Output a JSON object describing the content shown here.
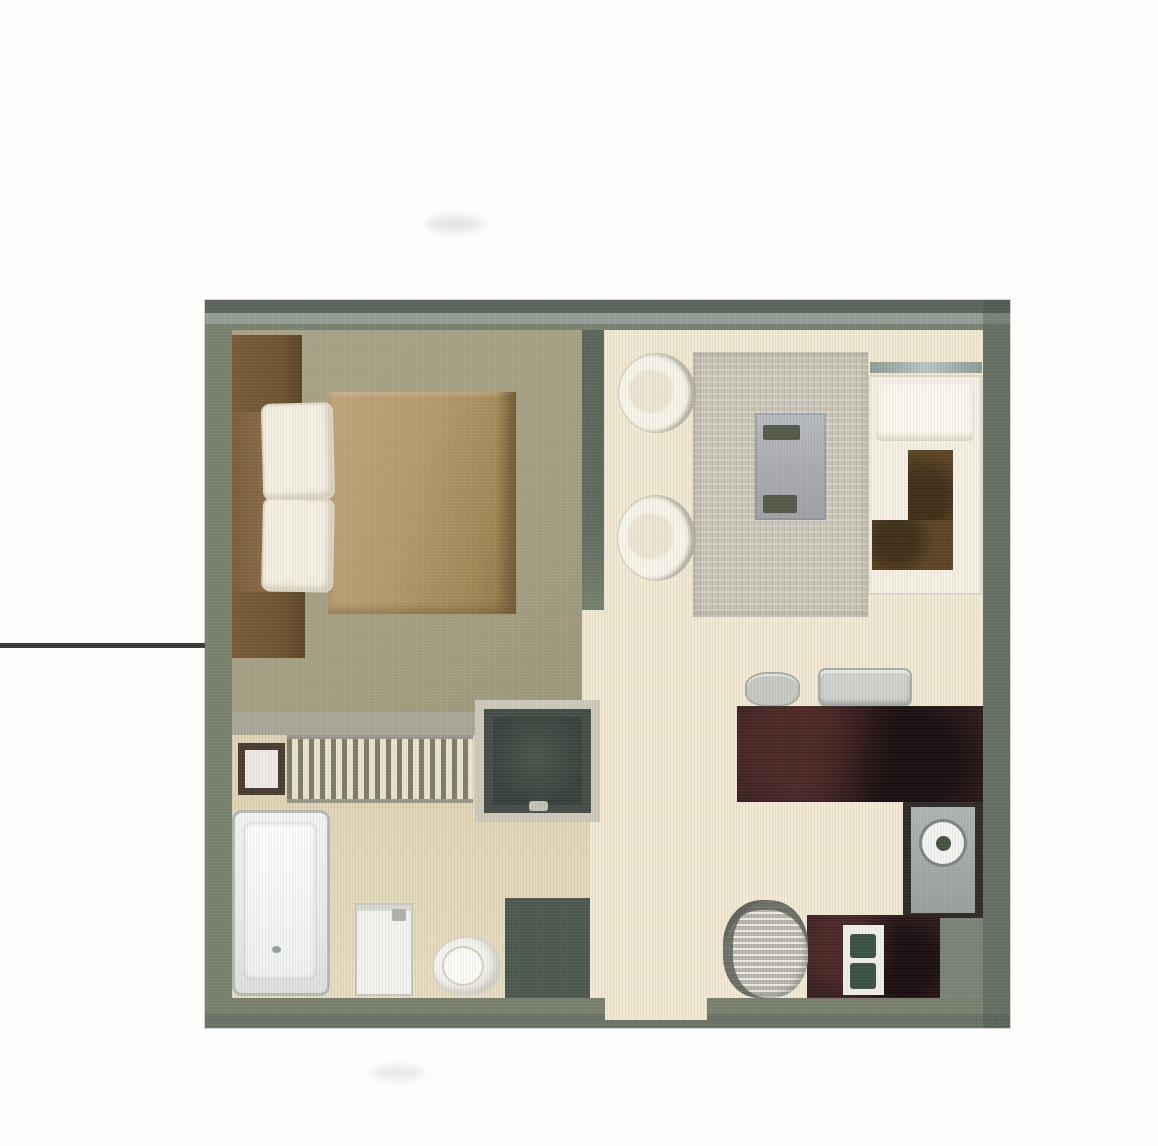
{
  "page": {
    "background_color": "#fdfdfc",
    "description": "Scanned top-down floor plan of a small studio apartment with a callout leader line entering from the left edge",
    "visible_text": []
  },
  "callout": {
    "type": "leader-line",
    "color": "#3c3c3c",
    "side": "left"
  },
  "floor_plan": {
    "type": "studio-apartment",
    "rooms": [
      {
        "name": "bedroom",
        "position": "top-left",
        "floor_color": "#a6a183",
        "furniture": [
          "wardrobe-top",
          "headboard",
          "pillow-1",
          "pillow-2",
          "double-bed-duvet",
          "wardrobe-bottom"
        ]
      },
      {
        "name": "bathroom",
        "position": "bottom-left",
        "floor_color": "#e3d8ba",
        "furniture": [
          "wall-fixture",
          "towel-radiator",
          "shower",
          "bathtub",
          "sink",
          "toilet"
        ]
      },
      {
        "name": "living-dining",
        "position": "top-right",
        "floor_color": "#f0e8d2",
        "furniture": [
          "round-chair-1",
          "round-chair-2",
          "area-rug",
          "dining-table",
          "wall-shelf",
          "daybed",
          "corner-cushion"
        ]
      },
      {
        "name": "kitchen",
        "position": "bottom-right",
        "floor_color": "#f0e8d2",
        "furniture": [
          "cookware-pot",
          "cookware-pan",
          "counter-upper",
          "washing-machine",
          "counter-lower",
          "stove",
          "round-stool"
        ]
      },
      {
        "name": "hallway",
        "position": "center",
        "floor_color": "#f0e8d2",
        "furniture": []
      }
    ],
    "openings": [
      "bedroom-doorway",
      "bathroom-doorway",
      "entry-opening-bottom-wall"
    ],
    "palette": {
      "wall": "#79816f",
      "wall_dark_edge": "#54605a",
      "wall_light_edge": "#9ea89f",
      "bedroom_floor": "#a6a183",
      "hall_floor": "#f0e8d2",
      "bathroom_floor": "#e3d8ba",
      "bed_duvet": "#b49a6d",
      "wardrobe_brown": "#6f5431",
      "counter_dark": "#341f21",
      "rug_gray": "#cbc5b7",
      "table_gray": "#abadb2",
      "cushion_brown": "#5d4526",
      "shower_dark": "#454f47",
      "fixture_white": "#f3efe2"
    }
  }
}
